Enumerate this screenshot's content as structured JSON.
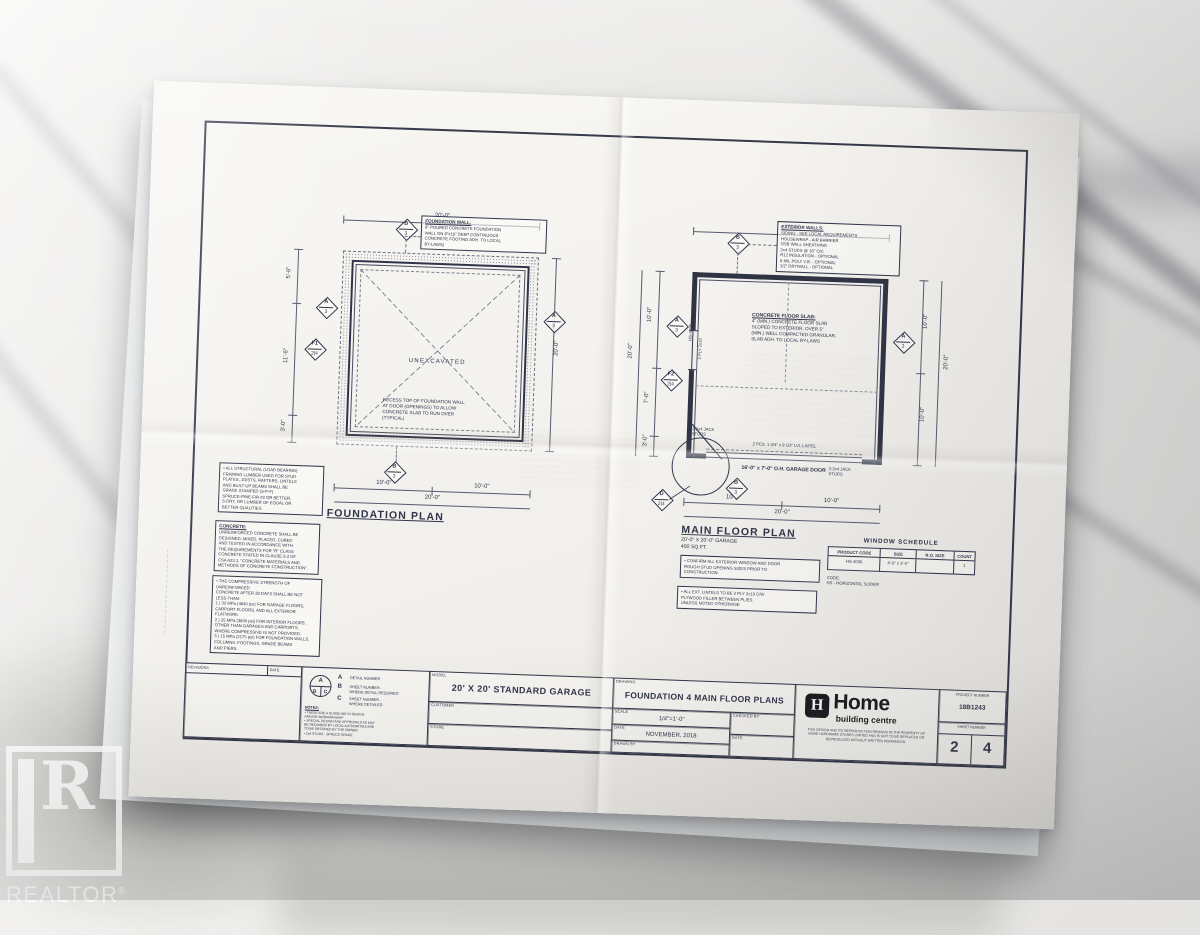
{
  "photo": {
    "watermark_name": "REALTOR",
    "watermark_reg": "®"
  },
  "foundation_plan": {
    "title": "FOUNDATION PLAN",
    "unexcavated": "UNEXCAVATED",
    "wall_note_title": "FOUNDATION WALL:",
    "wall_note_body": "8\" POURED CONCRETE FOUNDATION\nWALL ON 8\"x16\" DEEP CONTINUOUS\nCONCRETE FOOTING ADH. TO LOCAL\nBY-LAWS)",
    "recess_note": "RECESS TOP OF FOUNDATION WALL\nAT DOOR (OPENINGS) TO ALLOW\nCONCRETE SLAB TO RUN OVER\n(TYPICAL)",
    "dim_top": "20'-0\"",
    "dim_right": "20'-0\"",
    "dim_left_top": "5'-6\"",
    "dim_left_mid": "11'-6\"",
    "dim_left_bot": "3'-0\"",
    "dim_bottom_left": "10'-0\"",
    "dim_bottom_right": "10'-0\"",
    "dim_bottom_total": "20'-0\"",
    "callouts": {
      "top": {
        "a": "B",
        "b": "3"
      },
      "left1": {
        "a": "A",
        "b": "3"
      },
      "left2": {
        "a": "F1",
        "b": "2|4"
      },
      "right": {
        "a": "A",
        "b": "3"
      },
      "bottom": {
        "a": "B",
        "b": "3"
      }
    }
  },
  "main_floor_plan": {
    "title": "MAIN FLOOR PLAN",
    "subtitle": "20'-0\" X 20'-0\" GARAGE\n400 SQ.FT.",
    "ext_note_title": "EXTERIOR WALLS:",
    "ext_note_body": "SIDING - SEE LOCAL REQUIREMENTS\nHOUSEWRAP - AIR BARRIER\nOSB WALL SHEATHING\n2x4 STUDS @ 16\" O/C\nR12 INSULATION - OPTIONAL\n6 MIL POLY V.B. - OPTIONAL\n1/2\" DRYWALL - OPTIONAL",
    "slab_note_title": "CONCRETE FLOOR SLAB:",
    "slab_note_body": "4\" (MIN.) CONCRETE FLOOR SLAB\nSLOPED TO EXTERIOR, OVER 5\"\n(MIN.) WELL COMPACTED GRANULAR,\nSLAB ADH. TO LOCAL BY-LAWS",
    "lintel_label": "2 PCS. 1 3/4\" x 9 1/2\" LVL LINTEL",
    "door_label": "16'-0\" x 7'-0\" O.H. GARAGE DOOR",
    "jack_left": "2-2x4 JACK\nSTUDS",
    "jack_right": "2-2x4 JACK\nSTUDS",
    "window_code": "HS-4036",
    "window_lintel": "2 PLY 2x10",
    "dim_top": "20'-0\"",
    "dim_left_outer": "20'-0\"",
    "dim_left_top": "10'-0\"",
    "dim_left_mid": "7'-0\"",
    "dim_left_bot": "3'-0\"",
    "dim_right_top": "10'-0\"",
    "dim_right_bot": "10'-0\"",
    "dim_right_outer": "20'-0\"",
    "dim_bottom_left": "10'-0\"",
    "dim_bottom_right": "10'-0\"",
    "dim_bottom_total": "20'-0\"",
    "callouts": {
      "top": {
        "a": "B",
        "b": "3"
      },
      "left1": {
        "a": "A",
        "b": "3"
      },
      "left2": {
        "a": "F2",
        "b": "2|4"
      },
      "right": {
        "a": "A",
        "b": "3"
      },
      "detail": {
        "a": "D",
        "b": "2|4"
      },
      "bottom": {
        "a": "B",
        "b": "3"
      }
    }
  },
  "general_notes": {
    "framing": "• ALL STRUCTURAL (LOAD BEARING)\nFRAMING LUMBER USED FOR STUD\nPLATES, JOISTS, RAFTERS, LINTELS\nAND BUILT-UP BEAMS SHALL BE\nGRADE STAMPED (S-P-F)\nSPRUCE-PINE-FIR #2 OR BETTER,\nS-DRY, OR LUMBER OF EQUAL OR\nBETTER QUALITIES.",
    "concrete_title": "CONCRETE:",
    "concrete_body": "UNREINFORCED CONCRETE SHALL BE\nDESIGNED, MIXED, PLACED, CURED\nAND TESTED IN ACCORDANCE WITH\nTHE REQUIREMENTS FOR \"R\" CLASS\nCONCRETE STATED IN CLAUSE 9.3 OF\nCSA A23.1, \"CONCRETE MATERIALS AND\nMETHODS OF CONCRETE CONSTRUCTION\".",
    "strength": "• THE COMPRESSIVE STRENGTH OF UNREINFORCED\nCONCRETE AFTER 28 DAYS SHALL BE NOT\nLESS THAN:\n1.) 32 MPa (4640 psi) FOR GARAGE FLOORS,\nCARPORT FLOORS, AND ALL EXTERIOR\nFLATWORK.\n2.) 25 MPa (3600 psi) FOR INTERIOR FLOORS,\nOTHER THAN GARAGES AND CARPORTS,\nWHERE COMPRESSIVE IS NOT PROVIDED.\n3.) 15 MPa (2175 psi) FOR FOUNDATION WALLS,\nCOLUMNS, FOOTINGS, GRADE BEAMS\nAND PIERS."
  },
  "site_notes": {
    "note1": "• CONFIRM ALL EXTERIOR WINDOW AND DOOR\nROUGH STUD OPENING SIZES PRIOR TO\nCONSTRUCTION.",
    "note2": "• ALL EXT. LINTELS TO BE 2 PLY 2x10 C/W\nPLYWOOD FILLER BETWEEN PLIES,\nUNLESS NOTED OTHERWISE"
  },
  "window_schedule": {
    "title": "WINDOW SCHEDULE",
    "headers": [
      "PRODUCT CODE",
      "SIZE",
      "R.O. SIZE",
      "COUNT"
    ],
    "rows": [
      [
        "HS-4036",
        "4'-0\" x 3'-0\"",
        "",
        "1"
      ]
    ],
    "footnote": "CODE:\nHS - HORIZONTAL SLIDER"
  },
  "title_block": {
    "revisions_label": "REVISIONS",
    "revisions_date_label": "DATE",
    "legend": {
      "a_letter": "A",
      "a_desc": "DETAIL NUMBER",
      "b_letter": "B",
      "b_desc": "SHEET NUMBER -\nWHERE DETAIL REQUIRED",
      "c_letter": "C",
      "c_desc": "SHEET NUMBER -\nWHERE DETAILED",
      "circle_a": "A",
      "circle_b": "B",
      "circle_c": "C"
    },
    "notes_title": "NOTES:",
    "notes_body": "• THESE ARE A GUIDELINE IN DESIGN\nAND/OR WORKMANSHIP\n• SPECIAL DESIGN AND APPROVALS AS MAY\nBE REQUIRED BY LOCAL AUTHORITIES ARE\nTO BE OBTAINED BY THE OWNER\n• 2x4 STUDS - SPRUCE GRADE",
    "model_label": "MODEL",
    "model": "20' X 20' STANDARD GARAGE",
    "customer_label": "CUSTOMER",
    "store_label": "STORE",
    "drawing_label": "DRAWING",
    "drawing": "FOUNDATION 4 MAIN FLOOR PLANS",
    "scale_label": "SCALE",
    "scale": "1/4\"=1'-0\"",
    "date_label": "DATE",
    "date": "NOVEMBER, 2018",
    "drawn_by_label": "DRAWN BY",
    "checked_by_label": "CHECKED BY",
    "date2_label": "DATE",
    "logo_h": "H",
    "logo_name": "Home",
    "logo_sub": "building centre",
    "disclaimer": "THIS DESIGN AND ITS REPRODUCTION REMAINS IN THE PROPERTY OF\nHOME HARDWARE STORES LIMITED AND IS NOT TO BE REPLACED OR\nREPRODUCED WITHOUT WRITTEN PERMISSION.",
    "project_number_label": "PROJECT NUMBER",
    "project_number": "18B1243",
    "sheet_number_label": "SHEET NUMBER",
    "sheet_current": "2",
    "sheet_total": "4"
  }
}
